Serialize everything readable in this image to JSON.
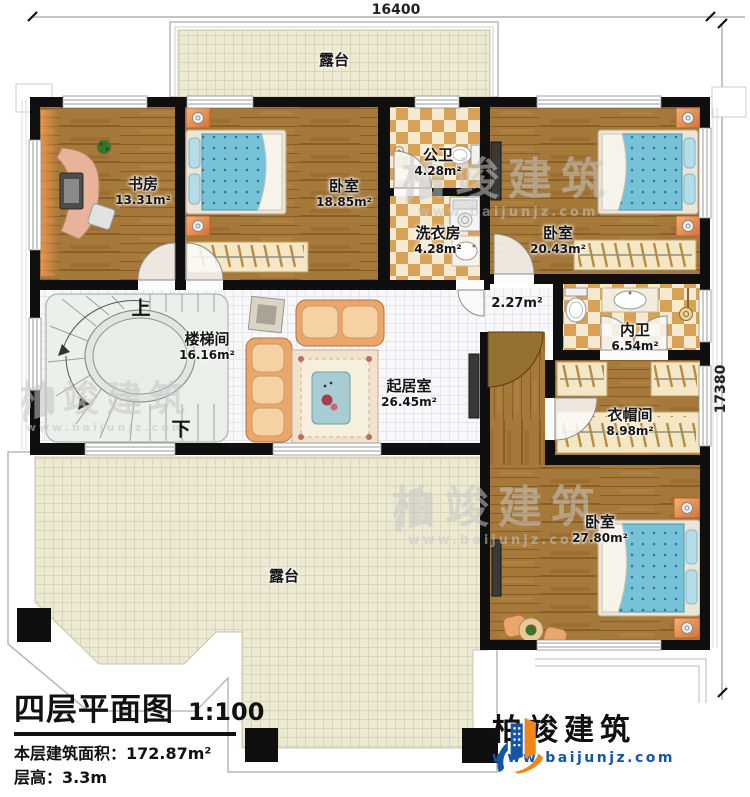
{
  "dimensions": {
    "top": "16400",
    "right": "17380"
  },
  "rooms": {
    "terrace_top": {
      "name": "露台"
    },
    "study": {
      "name": "书房",
      "area": "13.31m²"
    },
    "bedroom1": {
      "name": "卧室",
      "area": "18.85m²"
    },
    "public_bath": {
      "name": "公卫",
      "area": "4.28m²"
    },
    "laundry": {
      "name": "洗衣房",
      "area": "4.28m²"
    },
    "bedroom2": {
      "name": "卧室",
      "area": "20.43m²"
    },
    "stairwell": {
      "name": "楼梯间",
      "area": "16.16m²"
    },
    "hallway": {
      "area": "2.27m²"
    },
    "living": {
      "name": "起居室",
      "area": "26.45m²"
    },
    "ensuite": {
      "name": "内卫",
      "area": "6.54m²"
    },
    "cloakroom": {
      "name": "衣帽间",
      "area": "8.98m²"
    },
    "bedroom3": {
      "name": "卧室",
      "area": "27.80m²"
    },
    "terrace_bottom": {
      "name": "露台"
    }
  },
  "stairs": {
    "up": "上",
    "down": "下"
  },
  "title_block": {
    "title": "四层平面图",
    "scale": "1:100",
    "floor_area": "本层建筑面积：172.87m²",
    "floor_height": "层高：3.3m"
  },
  "branding": {
    "company": "柏竣建筑",
    "website": "www.baijunjz.com"
  },
  "watermark": {
    "company": "柏竣建筑",
    "website": "www.baijunjz.com"
  },
  "colors": {
    "wall": "#0f0f0f",
    "wood": "#a5793a",
    "tile_dark": "#d8a256",
    "tile_light": "#f5ead0",
    "terrace": "#edead4",
    "bed_blue": "#76c3d9",
    "brand_blue": "#1356a8",
    "brand_orange": "#f08519"
  }
}
